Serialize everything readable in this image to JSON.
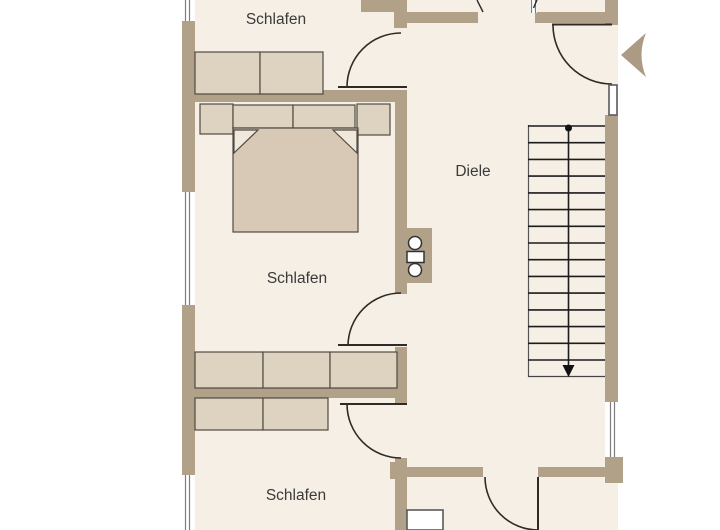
{
  "plan": {
    "labels": {
      "schlafen_top": "Schlafen",
      "schlafen_middle": "Schlafen",
      "schlafen_bottom": "Schlafen",
      "diele": "Diele"
    },
    "rooms": [
      {
        "id": "schlafen-top",
        "label": "Schlafen"
      },
      {
        "id": "schlafen-middle",
        "label": "Schlafen"
      },
      {
        "id": "diele",
        "label": "Diele"
      },
      {
        "id": "schlafen-bottom",
        "label": "Schlafen"
      }
    ],
    "stairs": {
      "tread_lines": 15,
      "direction": "down"
    },
    "entrance_arrow": {
      "direction": "left"
    },
    "colors": {
      "wall": "#b1a189",
      "floor": "#f6efe5",
      "furniture": "#ded2c1",
      "bed": "#d7c9b5",
      "outline": "#2e2a25",
      "furniture_outline": "#4f4a42",
      "stair_line": "#1c1c1c",
      "window_line": "#7d7d7d",
      "arrow": "#ab9b84",
      "text": "#3a3a3a",
      "background": "#ffffff"
    }
  }
}
